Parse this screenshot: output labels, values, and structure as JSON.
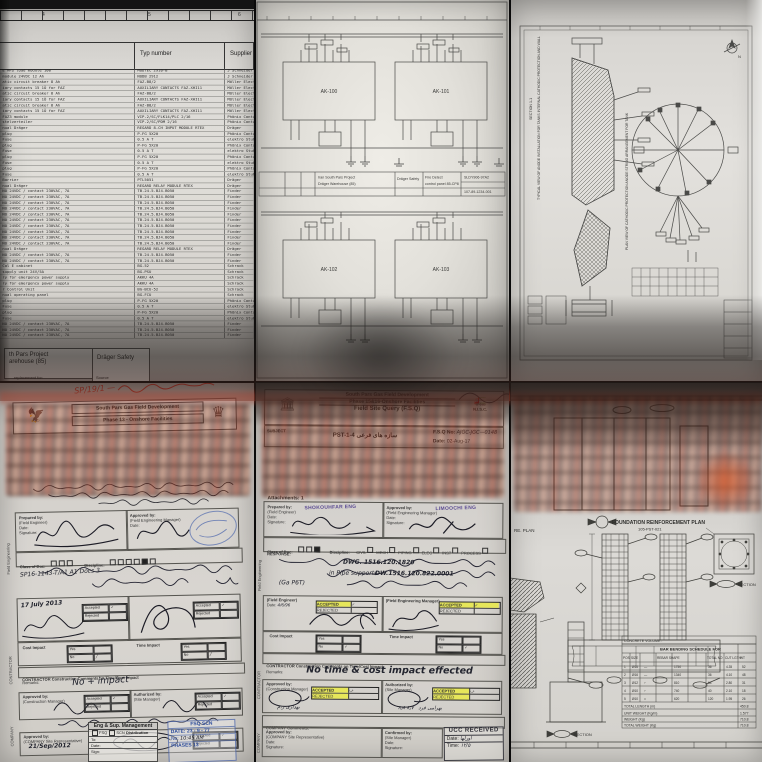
{
  "parts_list": {
    "ruler_numbers": [
      "4",
      "5",
      "6"
    ],
    "headers": {
      "description": "",
      "type": "Typ number",
      "supplier": "Supplier"
    },
    "rows": [
      {
        "d": "E MPS load module 100",
        "t": "MODTEC 2910-B",
        "s": "J Schneider"
      },
      {
        "d": "module 24VDC 12 Ah",
        "t": "NODB 2912",
        "s": "J Schneider"
      },
      {
        "d": "atic circuit breaker 8 Ah",
        "t": "FAZ-B8/2",
        "s": "Möller Electric"
      },
      {
        "d": "iary contacts 15 1Ö for FAZ",
        "t": "AUXILIARY CONTACTS FAZ-XHI11",
        "s": "Möller Electric"
      },
      {
        "d": "atic circuit breaker 8 Ah",
        "t": "FAZ-B8/2",
        "s": "Möller Electric"
      },
      {
        "d": "iary contacts 15 1Ö for FAZ",
        "t": "AUXILIARY CONTACTS FAZ-XHI11",
        "s": "Möller Electric"
      },
      {
        "d": "atic circuit breaker 8 Ah",
        "t": "FAZ-B8/2",
        "s": "Möller Electric"
      },
      {
        "d": "iary contacts 15 1Ö for FAZ",
        "t": "AUXILIARY CONTACTS FAZ-XHI11",
        "s": "Möller Electric"
      },
      {
        "d": "FAZ3 module",
        "t": "VIP-2/SC/FLK14/PLC 2/16",
        "s": "Phönix Contact"
      },
      {
        "d": "stelverteiler",
        "t": "VIP-2/SC/PDM 2/16",
        "s": "Phönix Contact"
      },
      {
        "d": "nual Dräger",
        "t": "REGARD 8-CH INPUT MODULE RTEX",
        "s": "Dräger"
      },
      {
        "d": "plug",
        "t": "P-FG 5X20",
        "s": "Phönix Contact"
      },
      {
        "d": "Fuse",
        "t": "0.5 A T",
        "s": "elektro Stuhr"
      },
      {
        "d": "plug",
        "t": "P-FG 5X20",
        "s": "Phönix Contact"
      },
      {
        "d": "Fuse",
        "t": "0.5 A T",
        "s": "elektro Stuhr"
      },
      {
        "d": "plug",
        "t": "P-FG 5X20",
        "s": "Phönix Contact"
      },
      {
        "d": "Fuse",
        "t": "0.5 A T",
        "s": "elektro Stuhr"
      },
      {
        "d": "plug",
        "t": "P-FG 5X20",
        "s": "Phönix Contact"
      },
      {
        "d": "Fuse",
        "t": "0.5 A T",
        "s": "elektro Stuhr"
      },
      {
        "d": "Barrier",
        "t": "PTL5051",
        "s": "Dräger"
      },
      {
        "d": "nual Dräger",
        "t": "REGARD RELAY MODULE RTEX",
        "s": "Dräger"
      },
      {
        "d": "NO 24VDC / contact 230VAC, 7A",
        "t": "TB.24.5.BJ4.B050",
        "s": "Finder"
      },
      {
        "d": "NO 24VDC / contact 230VAC, 7A",
        "t": "TB.24.5.BJ4.B050",
        "s": "Finder"
      },
      {
        "d": "NO 24VDC / contact 230VAC, 7A",
        "t": "TB.24.5.BJ4.B050",
        "s": "Finder"
      },
      {
        "d": "NO 24VDC / contact 230VAC, 7A",
        "t": "TB.24.5.BJ4.B050",
        "s": "Finder"
      },
      {
        "d": "NO 24VDC / contact 230VAC, 7A",
        "t": "TB.24.5.BJ4.B050",
        "s": "Finder"
      },
      {
        "d": "NO 24VDC / contact 230VAC, 7A",
        "t": "TB.24.5.BJ4.B050",
        "s": "Finder"
      },
      {
        "d": "NO 24VDC / contact 230VAC, 7A",
        "t": "TB.24.5.BJ4.B050",
        "s": "Finder"
      },
      {
        "d": "NO 24VDC / contact 230VAC, 7A",
        "t": "TB.24.5.BJ4.B050",
        "s": "Finder"
      },
      {
        "d": "NO 24VDC / contact 230VAC, 7A",
        "t": "TB.24.5.BJ4.B050",
        "s": "Finder"
      },
      {
        "d": "NO 24VDC / contact 230VAC, 7A",
        "t": "TB.24.5.BJ4.B050",
        "s": "Finder"
      },
      {
        "d": "nual Dräger",
        "t": "REGARD RELAY MODULE RTEX",
        "s": "Dräger"
      },
      {
        "d": "NO 24VDC / contact 230VAC, 7A",
        "t": "TB.24.5.BJ4.B050",
        "s": "Finder"
      },
      {
        "d": "NO 24VDC / contact 230VAC, 7A",
        "t": "TB.24.5.BJ4.B050",
        "s": "Finder"
      },
      {
        "d": "Cal E cabinet",
        "t": "BG-52",
        "s": "Schrack"
      },
      {
        "d": "supply unit 24V/5A",
        "t": "BG-PSU",
        "s": "Schrack"
      },
      {
        "d": "ry for emergency power supply",
        "t": "AKKU 4A",
        "s": "Schrack"
      },
      {
        "d": "ry for emergency power supply",
        "t": "AKKU 4A",
        "s": "Schrack"
      },
      {
        "d": "r Control Unit",
        "t": "BG-BCU-52",
        "s": "Schrack"
      },
      {
        "d": "nual operating panel",
        "t": "BG-FCU",
        "s": "Schrack"
      },
      {
        "d": "plug",
        "t": "P-FG 5X20",
        "s": "Phönix Contact"
      },
      {
        "d": "Fuse",
        "t": "0.5 A T",
        "s": "elektro Stuhr"
      },
      {
        "d": "plug",
        "t": "P-FG 5X20",
        "s": "Phönix Contact"
      },
      {
        "d": "Fuse",
        "t": "0.5 A T",
        "s": "elektro Stuhr"
      },
      {
        "d": "NO 24VDC / contact 230VAC, 7A",
        "t": "TB.24.5.BJ4.B050",
        "s": "Finder"
      },
      {
        "d": "NO 24VDC / contact 230VAC, 7A",
        "t": "TB.24.5.BJ4.B050",
        "s": "Finder"
      },
      {
        "d": "NO 24VDC / contact 230VAC, 7A",
        "t": "TB.24.5.BJ4.B050",
        "s": "Finder"
      }
    ],
    "footer": {
      "project_line1": "th Pars Project",
      "project_line2": "arehouse (85)",
      "replacement_label": "replacement for:",
      "source": "Source",
      "vendor": "Dräger Safety"
    }
  },
  "schematic": {
    "blocks": [
      "AK-100",
      "AK-101",
      "AK-102",
      "AK-103"
    ],
    "title_block": {
      "project1": "Iran South Pars Project",
      "project2": "Dräger Warehouse (85)",
      "company": "Dräger Safety",
      "title1": "Fire Detect",
      "title2": "control panel 85-CP8",
      "drawing_no": "SLDY906-97A2",
      "sheet_no": "107-89-1234-001"
    }
  },
  "cathodic_drawing": {
    "label_typical": "TYPICAL VIEW OF ANODE INSTALLATION FOR TANKS INTERNAL CATHODIC PROTECTION AND WALL",
    "label_plan": "PLAN VIEW OF CATHODIC PROTECTION ANODE STRING ARRANGEMENT FOR TANK",
    "label_section": "SECTION 1-1",
    "north": "N"
  },
  "fsq13": {
    "red_note": "SP/19/1 —",
    "header_line1": "South Pars Gas Field Development",
    "header_line2": "Phase 13 - Onshore Facilities",
    "prepared_label": "Prepared by:",
    "prepared_sub": "(Field Engineer)",
    "approved_label": "Approved by:",
    "approved_sub": "(Field Engineering Manager)",
    "date_label": "Date:",
    "signature_label": "Signature:",
    "class_label": "Class of Doc:",
    "discipline_label": "Discipline:",
    "code_line": "SP16-1143-T/A1 A1 Docs 3",
    "date_value": "17 July 2013",
    "accepted_label": "Accepted",
    "rejected_label": "Rejected",
    "cost_impact_label": "Cost Impact",
    "time_impact_label": "Time Impact",
    "yes_label": "Yes",
    "no_label": "No",
    "contractor_comments_label": "CONTRACTOR Construction Comments on Time/Cost Impact",
    "remarks_label": "Remarks:",
    "remarks_value": "No + impact",
    "cm_label": "Approved by:",
    "cm_sub": "(Construction Manager)",
    "auth_label": "Authorized by:",
    "auth_sub": "(Site Manager)",
    "company_label": "Approved by:",
    "company_sub": "(COMPANY Site Representative)",
    "company_date": "21/Sep/2012",
    "dist_title": "Eng & Sup. Management",
    "dist_fsq": "FSQ",
    "dist_scn": "SCN",
    "dist_label": "Distribution",
    "dist_rows": [
      "To:",
      "Date:",
      "Sign:"
    ],
    "stamp_line1": "FSQ      SCN",
    "stamp_date": "DATE: 23 - 9 - 77",
    "stamp_no": "No:",
    "stamp_time": "10:45 AM",
    "stamp_phase": "PHASES 13",
    "side_label1": "Field Engineering",
    "side_label2": "CONTRACTOR",
    "side_label3": "COMPANY"
  },
  "fsq1516": {
    "header_line1": "South Pars Gas Field Development",
    "header_line2": "Phase 15&16-Onshore Facilities",
    "header_line3": "Field Site Query (F.S.Q)",
    "logo_right": "N.I.S.C.",
    "subject_label": "SUBJECT",
    "subject_value": "PST-1-4 سازه های فرعی",
    "fsq_no_label": "F.S.Q No:",
    "fsq_no_value": "AJGC-JGC—0148",
    "date_label": "Date:",
    "date_value": "02-Aug-17",
    "attachments": "Attachments: 1",
    "prepared_label": "Prepared by:",
    "prepared_sub": "(Field Engineer)",
    "prepared_name": "SHOKOUHFAR ENG",
    "approved_label": "Approved by:",
    "approved_sub": "(Field Engineering Manager)",
    "approved_name": "LIMOOCHI ENG",
    "signature_label": "Signature:",
    "class_label": "Class of Doc:",
    "discipline_label": "Discipline:",
    "disciplines": [
      "CIVIL",
      "MECH",
      "PIPING",
      "ELEC",
      "INST",
      "PROCESS"
    ],
    "response_label": "RESPONSE:",
    "response_line1": "DWG. 1516.120.1820",
    "response_line2": "DW.1516.120.822.0001",
    "response_line3": "in Pipe supports",
    "response_line4": "(Ga P6T)",
    "fe_label": "(Field Engineer)",
    "fem_label": "(Field Engineering Manager)",
    "accepted_label": "ACCEPTED",
    "rejected_label": "REJECTED",
    "fe_date": "4/6/96",
    "cost_impact_label": "Cost Impact",
    "time_impact_label": "Time Impact",
    "yes_label": "Yes",
    "no_label": "No",
    "contractor_comments_label": "CONTRACTOR Construction Comments on Time/Cost Impact",
    "remarks_label": "Remarks:",
    "remarks_value": "No time & cost impact effected",
    "cm_label": "Approved by:",
    "cm_sub": "(Construction Manager)",
    "sm_label": "Authorized by:",
    "sm_sub": "(Site Manager)",
    "company_comments_label": "COMPANY Comments:",
    "company_approved_label": "Approved by:",
    "company_approved_sub": "(COMPANY Site Representative)",
    "confirmed_label": "Confirmed by:",
    "confirmed_sub": "(Site Manager)",
    "received_stamp": "UCC RECEIVED",
    "received_date_label": "Date:",
    "received_time_label": "Time:",
    "side_label1": "Field Engineering",
    "side_label2": "CONTRACTOR",
    "side_label3": "COMPANY"
  },
  "rebar_drawing": {
    "title": "FOUNDATION REINFORCEMENT PLAN",
    "title_no": "105-PST-021",
    "plan_label": "RE. PLAN",
    "section_label": "SECTION",
    "concrete_volume_label": "CONCRETE VOLUME :",
    "bbs_title": "BAR BENDING SCHEDULE FOR",
    "bbs_headers": [
      "POS",
      "SIZE",
      "REBAR SHAPE",
      "TOTAL NO",
      "CUT LGTH",
      "WT"
    ],
    "bbs_rows": [
      [
        "1",
        "Ø16",
        "—",
        "1750",
        "36",
        "4.35",
        "52"
      ],
      [
        "2",
        "Ø16",
        "—",
        "1340",
        "36",
        "4.10",
        "48"
      ],
      [
        "3",
        "Ø12",
        "⌐",
        "810",
        "64",
        "2.80",
        "31"
      ],
      [
        "4",
        "Ø10",
        "⌐",
        "740",
        "40",
        "2.10",
        "18"
      ],
      [
        "5",
        "Ø10",
        "□",
        "620",
        "120",
        "1.95",
        "26"
      ]
    ],
    "bbs_footer": [
      {
        "label": "TOTAL LENGTH (m)",
        "val": "450.8"
      },
      {
        "label": "UNIT WEIGHT (Kg/m)",
        "val": "1.577"
      },
      {
        "label": "WEIGHT (Kg)",
        "val": "710.8"
      },
      {
        "label": "TOTAL WEIGHT (Kg)",
        "val": "710.8"
      }
    ]
  }
}
